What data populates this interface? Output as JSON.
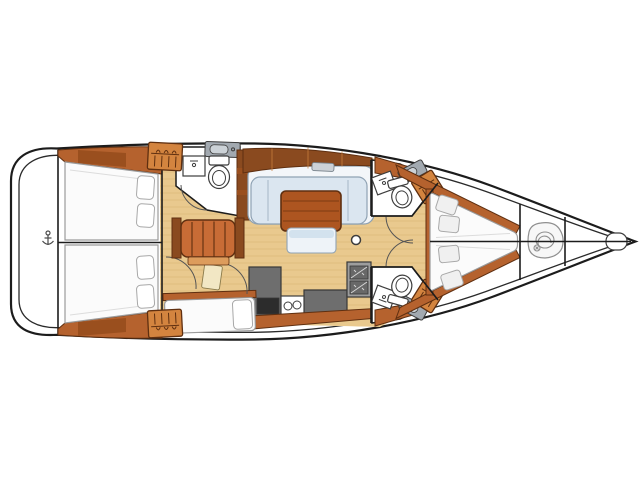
{
  "canvas": {
    "width": 640,
    "height": 479
  },
  "colors": {
    "bg": "#ffffff",
    "hull_stroke": "#1c1c1c",
    "inner_stroke": "#2a2a2a",
    "floor": "#e9c98e",
    "plank": "#d8b272",
    "wood_mid": "#b5622e",
    "wood_dark": "#8a4a1f",
    "wood_light": "#c9803f",
    "wood_panel": "#9a4f1e",
    "wood_line": "#5f2f10",
    "stairs": "#c86c36",
    "stairs_apron": "#dd9c5c",
    "locker": "#d3843f",
    "table": "#ad5520",
    "table_line": "#7d3a12",
    "mattress": "#fbfbfb",
    "mattress_line": "#9b9b9b",
    "pillow": "#ffffff",
    "vpillow": "#f0f0f0",
    "pillow_line": "#a8a8a8",
    "settee_back": "#f3f6f9",
    "settee_cushion": "#dbe6f0",
    "settee_line": "#8fa2b3",
    "bench": "#eef3f8",
    "bench_band": "#d3e2ee",
    "counter": "#6e6e6e",
    "counter_line": "#383838",
    "oven": "#2c2c2c",
    "stove": "#9d9d9d",
    "burner": "#686868",
    "bath_counter": "#a2a9b0",
    "basin": "#ccd2d7",
    "fixture_line": "#3d3d3d",
    "door_arc": "#555555",
    "cream_door": "#f2e7c4",
    "rope": "#8f8f8f",
    "hatch": "#ccd1d6"
  },
  "inventory": {
    "aft_double_cabins": 2,
    "forward_v_berth_cabins": 1,
    "single_berths": 1,
    "heads_bathrooms": 3,
    "toilets": 3,
    "hand_basins": 3,
    "vanity_counters": 3,
    "wardrobe_lockers": 4,
    "galley_burners": 2,
    "galley_sinks": 2,
    "salon_tables": 1,
    "companionway_stairs": 1,
    "pillows_total": 9
  },
  "icons": [
    "anchor-icon",
    "hanger-locker-icon",
    "rope-coil-icon",
    "toilet-icon",
    "sink-faucet-icon",
    "stove-burner-icon",
    "deck-hatch-icon"
  ]
}
